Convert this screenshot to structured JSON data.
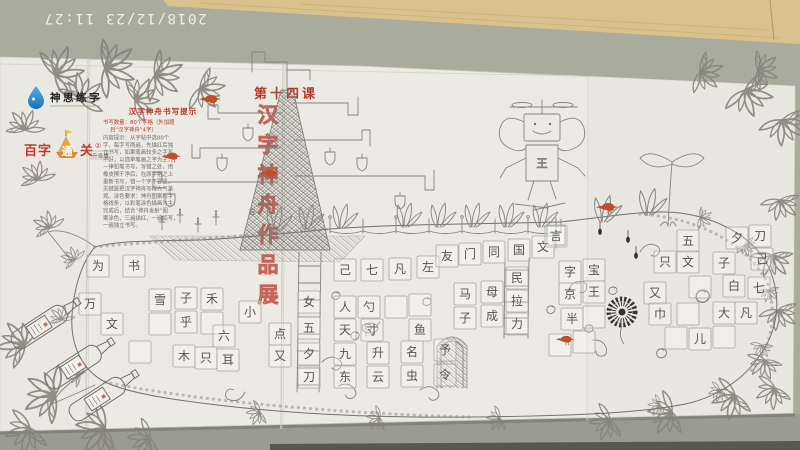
{
  "camera": {
    "timestamp": "2018/12/23 11:27"
  },
  "page": {
    "lesson": "第十四课",
    "vertical_title": "汉字神舟作品展",
    "vertical_title_chars": [
      "汉",
      "字",
      "神",
      "舟",
      "作",
      "品",
      "展"
    ],
    "tips": {
      "title": "汉字神舟书写提示",
      "red_lines": [
        "书写数量：80个字格（外加题",
        "目“汉字神舟”4字）"
      ],
      "body_lines": [
        "内容提示：从字帖中选80个",
        "字，每字写两遍，先描红后独",
        "立书写，如果笔画较多之字写",
        "不好，以简单笔画之字为主，",
        "一律铅笔书写，写错之处，用",
        "橡皮擦干净后，在原字格之上",
        "重新书写，错一个字不要紧，",
        "关键是把汉字神舟写得大气美",
        "观。涂色要求：神舟图案和字",
        "格线条，以彩笔涂色描画为主，",
        "完成后，结合“神舟发射”图",
        "案涂色，三遍描红，一遍临写，",
        "一遍独立书写。"
      ]
    }
  },
  "logos": {
    "shensi": {
      "name": "神思练字",
      "drop_color": "#2e86c8"
    },
    "baizi": {
      "part1": "百字",
      "part2": "通",
      "part3": "关",
      "badge": "②",
      "edition": "升级版",
      "accent": "#e8a33d"
    }
  },
  "art": {
    "robot_chest_char": "王",
    "tree_char": "吉",
    "bird_color": "#bf4e2b",
    "red_accent": "#b8392e"
  },
  "grid_cells": [
    [
      98,
      266,
      "为"
    ],
    [
      134,
      266,
      "书"
    ],
    [
      90,
      304,
      "万"
    ],
    [
      112,
      324,
      "文"
    ],
    [
      160,
      300,
      "雪"
    ],
    [
      186,
      298,
      "子"
    ],
    [
      212,
      299,
      "禾"
    ],
    [
      160,
      324,
      ""
    ],
    [
      186,
      322,
      "乎"
    ],
    [
      212,
      323,
      ""
    ],
    [
      140,
      352,
      ""
    ],
    [
      184,
      356,
      "木"
    ],
    [
      206,
      358,
      "只"
    ],
    [
      228,
      360,
      "耳"
    ],
    [
      224,
      336,
      "六"
    ],
    [
      250,
      312,
      "小"
    ],
    [
      280,
      334,
      "点"
    ],
    [
      280,
      356,
      "又"
    ],
    [
      309,
      302,
      "女"
    ],
    [
      309,
      328,
      "五"
    ],
    [
      309,
      354,
      "夕"
    ],
    [
      309,
      377,
      "刀"
    ],
    [
      345,
      270,
      "己"
    ],
    [
      372,
      270,
      "七"
    ],
    [
      400,
      269,
      "凡"
    ],
    [
      428,
      267,
      "左"
    ],
    [
      345,
      307,
      "人"
    ],
    [
      369,
      307,
      "勺"
    ],
    [
      396,
      307,
      ""
    ],
    [
      420,
      305,
      ""
    ],
    [
      345,
      330,
      "天"
    ],
    [
      372,
      330,
      "寸"
    ],
    [
      420,
      330,
      "鱼"
    ],
    [
      345,
      354,
      "九"
    ],
    [
      378,
      353,
      "升"
    ],
    [
      412,
      352,
      "名"
    ],
    [
      445,
      350,
      "予"
    ],
    [
      345,
      377,
      "东"
    ],
    [
      378,
      377,
      "云"
    ],
    [
      412,
      376,
      "虫"
    ],
    [
      445,
      375,
      "令"
    ],
    [
      447,
      256,
      "友"
    ],
    [
      470,
      254,
      "门"
    ],
    [
      494,
      252,
      "同"
    ],
    [
      519,
      250,
      "国"
    ],
    [
      543,
      247,
      "文"
    ],
    [
      465,
      294,
      "马"
    ],
    [
      492,
      292,
      "母"
    ],
    [
      465,
      318,
      "子"
    ],
    [
      492,
      316,
      "成"
    ],
    [
      517,
      278,
      "民"
    ],
    [
      517,
      301,
      "拉"
    ],
    [
      517,
      324,
      "力"
    ],
    [
      570,
      272,
      "字"
    ],
    [
      594,
      270,
      "宝"
    ],
    [
      570,
      294,
      "京"
    ],
    [
      594,
      292,
      "王"
    ],
    [
      572,
      319,
      "半"
    ],
    [
      594,
      317,
      ""
    ],
    [
      560,
      345,
      ""
    ],
    [
      584,
      342,
      ""
    ],
    [
      556,
      236,
      "言"
    ],
    [
      688,
      241,
      "五"
    ],
    [
      737,
      238,
      "夕"
    ],
    [
      760,
      236,
      "刀"
    ],
    [
      665,
      262,
      "只"
    ],
    [
      688,
      262,
      "文"
    ],
    [
      724,
      263,
      "子"
    ],
    [
      762,
      259,
      "己"
    ],
    [
      734,
      286,
      "白"
    ],
    [
      759,
      288,
      "七"
    ],
    [
      655,
      293,
      "又"
    ],
    [
      700,
      287,
      ""
    ],
    [
      660,
      314,
      "巾"
    ],
    [
      724,
      313,
      "大"
    ],
    [
      746,
      313,
      "凡"
    ],
    [
      688,
      314,
      ""
    ],
    [
      700,
      339,
      "儿"
    ],
    [
      676,
      338,
      ""
    ],
    [
      724,
      337,
      ""
    ]
  ]
}
